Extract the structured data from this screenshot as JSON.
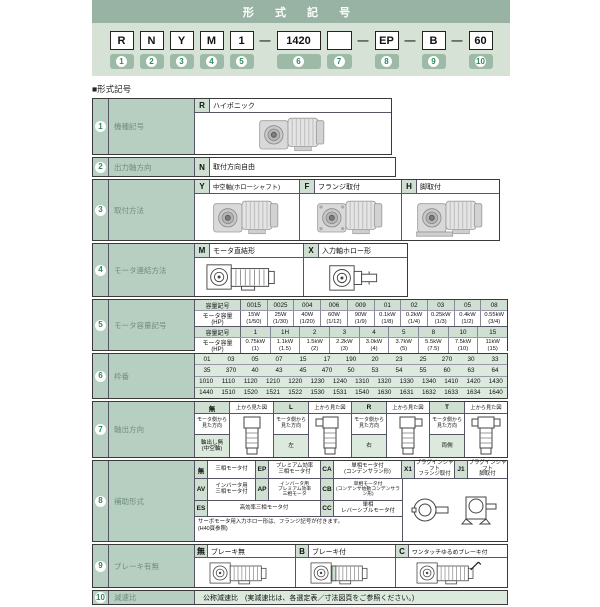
{
  "colors": {
    "banner_header": "#98b2a3",
    "banner_panel": "#d6e2d6",
    "label_cell": "#b7cfc0",
    "symbol_cell": "#cfe0d2",
    "striped_cell": "#dce9dd",
    "number_green": "#2f8a5f"
  },
  "banner": {
    "title": "形 式 記 号",
    "dash": "—",
    "units": [
      {
        "box": "R",
        "num": "1"
      },
      {
        "box": "N",
        "num": "2"
      },
      {
        "box": "Y",
        "num": "3"
      },
      {
        "box": "M",
        "num": "4"
      },
      {
        "box": "1",
        "num": "5"
      },
      {
        "box": "1420",
        "num": "6"
      },
      {
        "box": "",
        "num": "7"
      },
      {
        "box": "EP",
        "num": "8"
      },
      {
        "box": "B",
        "num": "9"
      },
      {
        "box": "60",
        "num": "10"
      }
    ]
  },
  "section_title": "■形式記号",
  "rows": {
    "r1": {
      "num": "1",
      "label": "機種記号",
      "sym": "R",
      "desc": "ハイポニック"
    },
    "r2": {
      "num": "2",
      "label": "出力軸方向",
      "sym": "N",
      "desc": "取付方向自由"
    },
    "r3": {
      "num": "3",
      "label": "取付方法",
      "cells": [
        {
          "sym": "Y",
          "desc": "中空軸(ホローシャフト)"
        },
        {
          "sym": "F",
          "desc": "フランジ取付"
        },
        {
          "sym": "H",
          "desc": "脚取付"
        }
      ]
    },
    "r4": {
      "num": "4",
      "label": "モータ連結方法",
      "cells": [
        {
          "sym": "M",
          "desc": "モータ直結形"
        },
        {
          "sym": "X",
          "desc": "入力軸ホロー形"
        }
      ]
    },
    "r5": {
      "num": "5",
      "label": "モータ容量記号",
      "t1": {
        "h1": "容量記号",
        "h2": "モータ容量\n(HP)",
        "syms": [
          "0015",
          "0025",
          "004",
          "006",
          "009",
          "01",
          "02",
          "03",
          "05",
          "08"
        ],
        "caps": [
          "15W\n(1/50)",
          "25W\n(1/30)",
          "40W\n(1/20)",
          "60W\n(1/12)",
          "90W\n(1/9)",
          "0.1kW\n(1/8)",
          "0.2kW\n(1/4)",
          "0.25kW\n(1/3)",
          "0.4kW\n(1/2)",
          "0.55kW\n(3/4)"
        ]
      },
      "t2": {
        "h1": "容量記号",
        "h2": "モータ容量\n(HP)",
        "syms": [
          "1",
          "1H",
          "2",
          "3",
          "4",
          "5",
          "8",
          "10",
          "15"
        ],
        "caps": [
          "0.75kW\n(1)",
          "1.1kW\n(1.5)",
          "1.5kW\n(2)",
          "2.2kW\n(3)",
          "3.0kW\n(4)",
          "3.7kW\n(5)",
          "5.5kW\n(7.5)",
          "7.5kW\n(10)",
          "11kW\n(15)"
        ]
      }
    },
    "r6": {
      "num": "6",
      "label": "枠番",
      "lines": [
        [
          "01",
          "03",
          "05",
          "07",
          "15",
          "17",
          "190",
          "20",
          "23",
          "25",
          "270",
          "30",
          "33"
        ],
        [
          "35",
          "370",
          "40",
          "43",
          "45",
          "470",
          "50",
          "53",
          "54",
          "55",
          "60",
          "63",
          "64"
        ],
        [
          "1010",
          "1110",
          "1120",
          "1210",
          "1220",
          "1230",
          "1240",
          "1310",
          "1320",
          "1330",
          "1340",
          "1410",
          "1420",
          "1430"
        ],
        [
          "1440",
          "1510",
          "1520",
          "1521",
          "1522",
          "1530",
          "1531",
          "1540",
          "1630",
          "1631",
          "1632",
          "1633",
          "1634",
          "1640"
        ]
      ]
    },
    "r7": {
      "num": "7",
      "label": "軸出方向",
      "view_label": "上から見た図",
      "dir_label": "モータ側から\n見た方向",
      "groups": [
        {
          "sym": "無",
          "value": "軸出し無\n(中空軸)"
        },
        {
          "sym": "L",
          "value": "左"
        },
        {
          "sym": "R",
          "value": "右"
        },
        {
          "sym": "T",
          "value": "両側"
        }
      ]
    },
    "r8": {
      "num": "8",
      "label": "補助形式",
      "a": [
        {
          "sym": "無",
          "desc": "三相モータ付"
        },
        {
          "sym": "EP",
          "desc": "プレミアム効率\n三相モータ付"
        },
        {
          "sym": "CA",
          "desc": "単相モータ付\n(コンデンサラン形)"
        },
        {
          "sym": "X1",
          "desc": "プラグインシャフト\nフランジ取付"
        },
        {
          "sym": "J1",
          "desc": "プラグインシャフト\n脚取付"
        }
      ],
      "b": [
        {
          "sym": "AV",
          "desc": "インバータ用\n三相モータ付"
        },
        {
          "sym": "AP",
          "desc": "インバータ用\nプレミアム効率\n三相モータ"
        },
        {
          "sym": "CB",
          "desc": "単相モータ付\n(コンデンサ始動コンデンサラン形)"
        }
      ],
      "c": [
        {
          "sym": "ES",
          "desc": "高効率三相モータ付"
        },
        {
          "sym": "CC",
          "desc": "単相\nレバーシブルモータ付"
        }
      ],
      "note": "サーボモータ用入力ホロー形は、フランジ記号が付きます。\n(H40頁参照)"
    },
    "r9": {
      "num": "9",
      "label": "ブレーキ有無",
      "cells": [
        {
          "sym": "無",
          "desc": "ブレーキ無"
        },
        {
          "sym": "B",
          "desc": "ブレーキ付"
        },
        {
          "sym": "C",
          "desc": "ワンタッチゆるめブレーキ付"
        }
      ]
    },
    "r10": {
      "num": "10",
      "label": "減速比",
      "desc": "公称減速比　(実減速比は、各選定表／寸法図頁をご参照ください。)"
    }
  }
}
